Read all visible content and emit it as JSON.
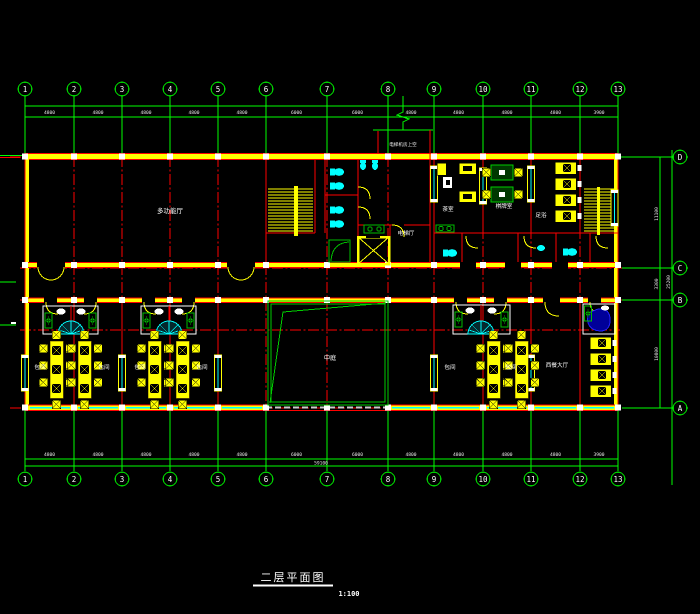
{
  "drawing": {
    "title": "二层平面图",
    "scale": "1:100",
    "grid": {
      "cols": [
        "1",
        "2",
        "3",
        "4",
        "5",
        "6",
        "7",
        "8",
        "9",
        "10",
        "11",
        "12",
        "13"
      ],
      "rows": [
        "D",
        "C",
        "B",
        "A"
      ]
    },
    "dims": {
      "top": [
        "4800",
        "4800",
        "4800",
        "4800",
        "4800",
        "6000",
        "6000",
        "4800",
        "4800",
        "4800",
        "4800",
        "3900"
      ],
      "bottom": [
        "4800",
        "4800",
        "4800",
        "4800",
        "4800",
        "6000",
        "6000",
        "4800",
        "4800",
        "4800",
        "4800",
        "3900"
      ],
      "bottom_total": "59100",
      "right": [
        "11100",
        "3300",
        "10800"
      ],
      "right_total": "25200"
    },
    "labels": {
      "hall": "多功能厅",
      "machine_room": "电梯机房上空",
      "elevator_hall": "电梯厅",
      "tea_room": "茶室",
      "chess_room": "棋牌室",
      "foot_room": "足浴",
      "atrium": "中庭",
      "private_room": "包间",
      "west_hall": "西餐大厅"
    },
    "colors": {
      "background": "#000000",
      "wall": "#ffff00",
      "axis": "#ff0000",
      "dimension": "#00ff00",
      "fixture": "#00ffff",
      "table_green": "#00bb00",
      "spa_blue": "#0000cc",
      "text": "#ffffff"
    }
  }
}
